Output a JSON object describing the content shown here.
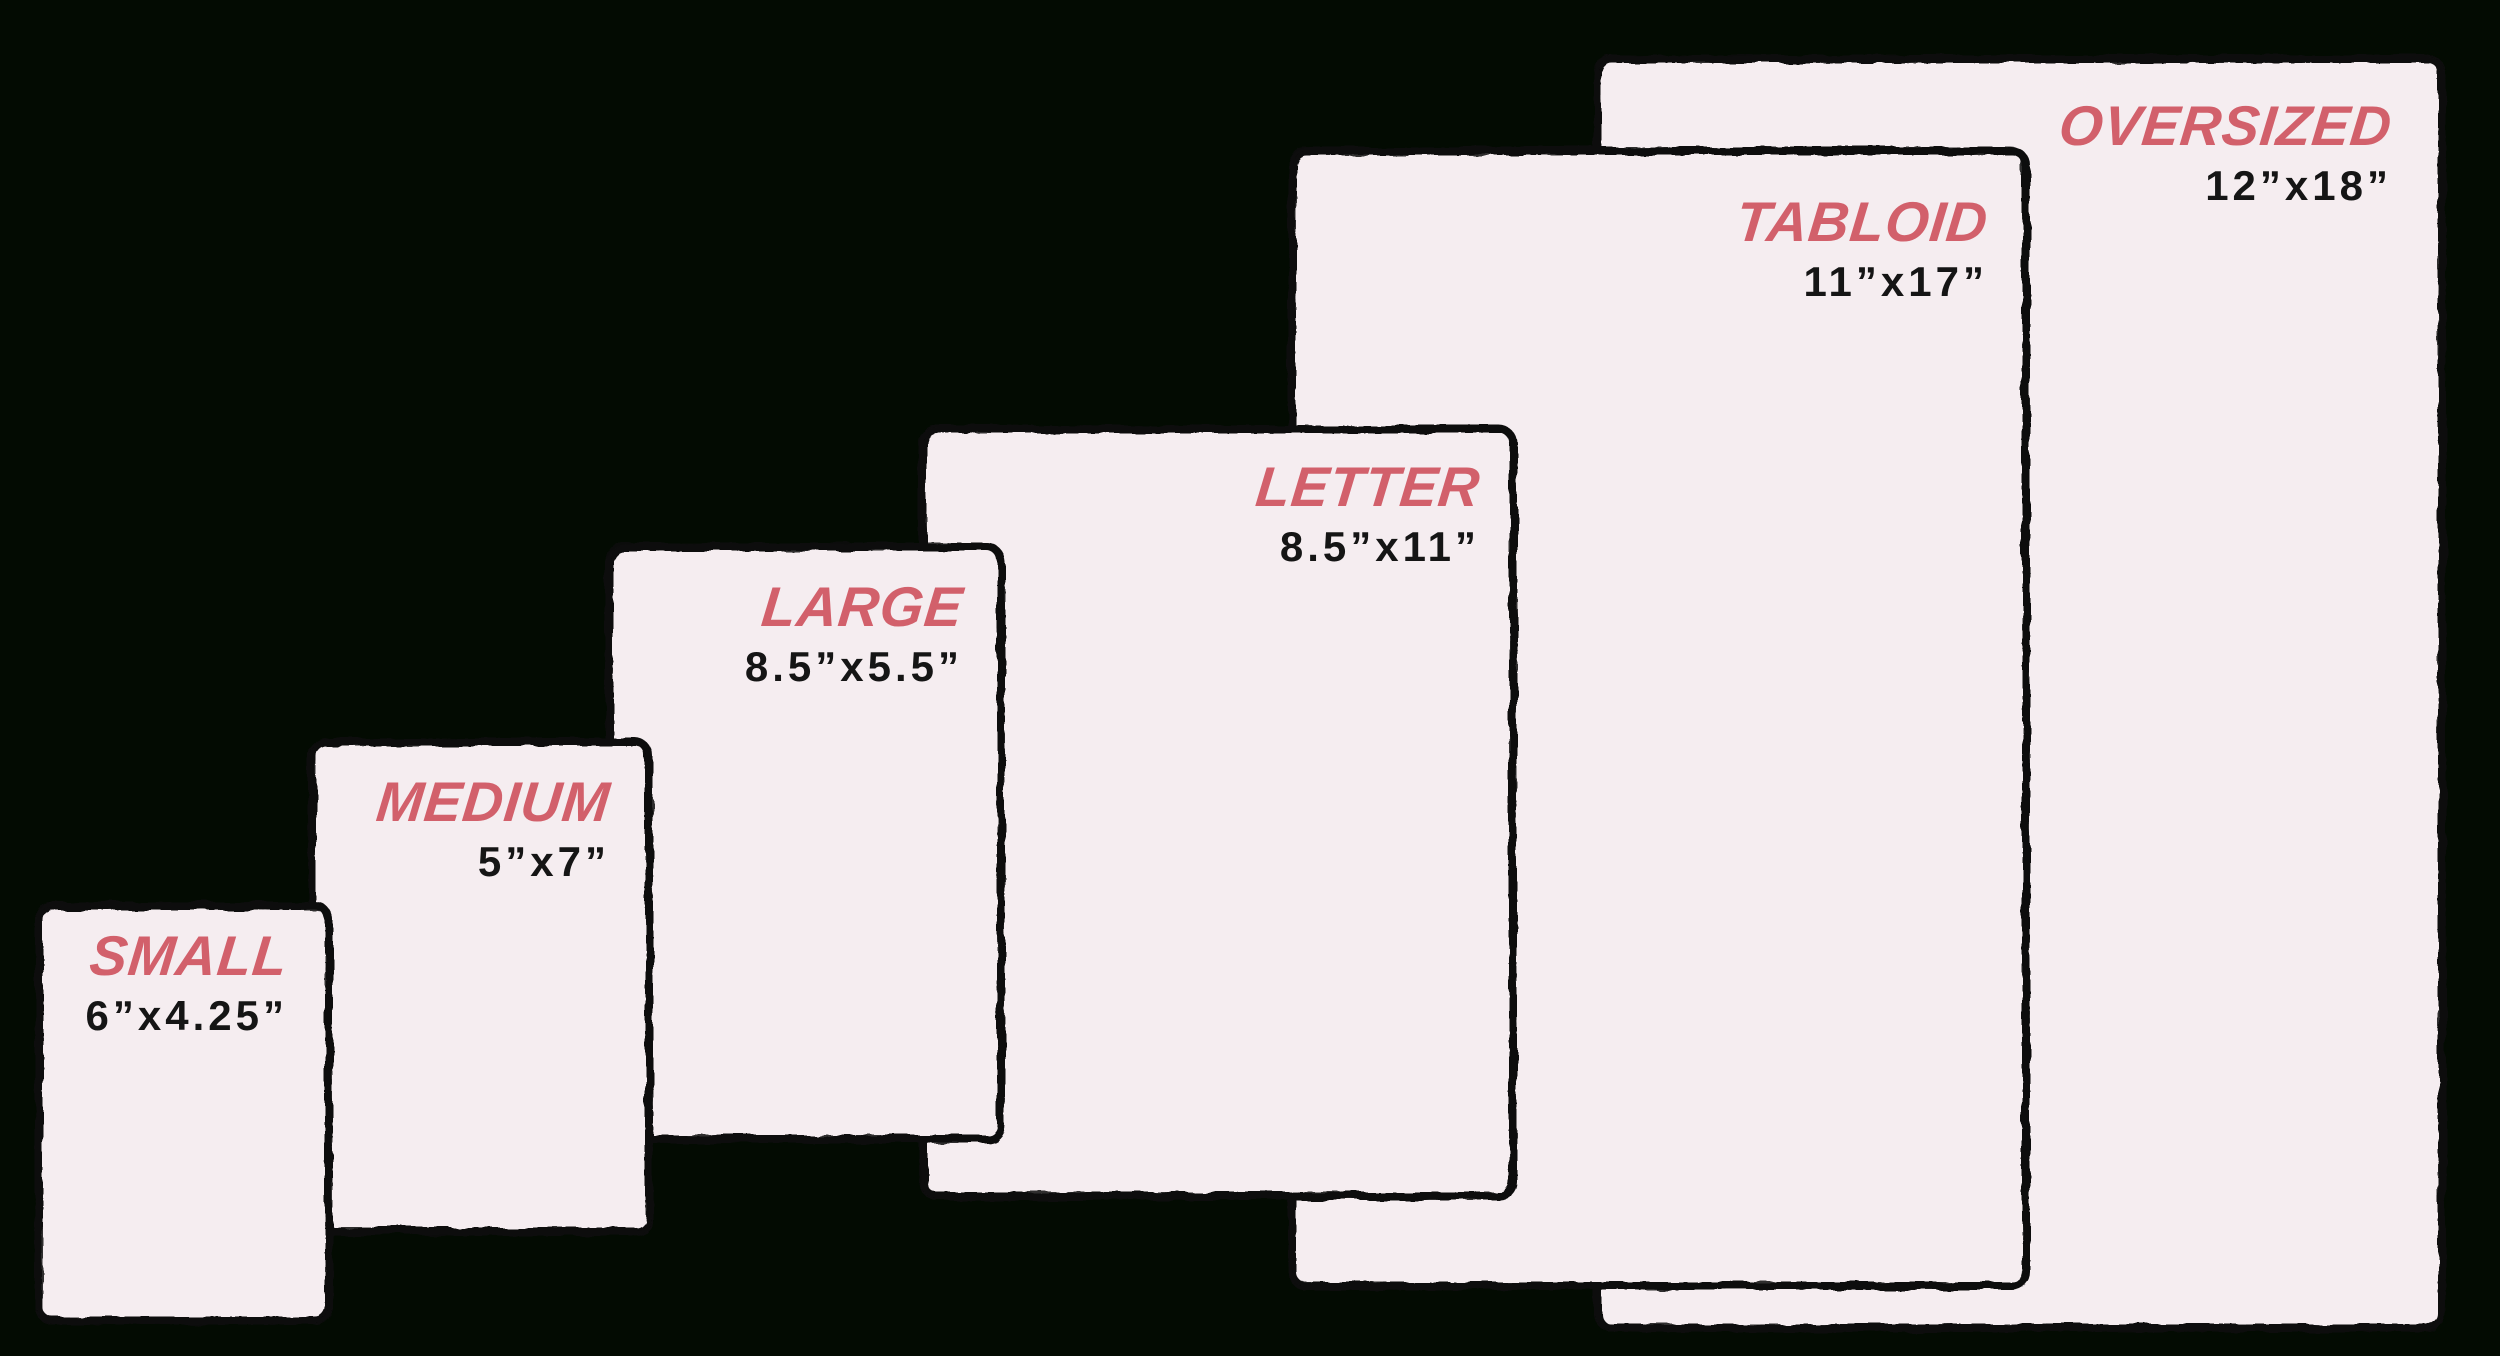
{
  "diagram": {
    "description": "Paper size comparison",
    "colors": {
      "background": "#030b02",
      "card_fill": "#f5edf0",
      "card_border": "#0d0d0d",
      "label_red": "#d2606b",
      "dimension_text": "#151515"
    },
    "cards": [
      {
        "id": "small",
        "label": "SMALL",
        "dimensions": "6”x4.25”"
      },
      {
        "id": "medium",
        "label": "MEDIUM",
        "dimensions": "5”x7”"
      },
      {
        "id": "large",
        "label": "LARGE",
        "dimensions": "8.5”x5.5”"
      },
      {
        "id": "letter",
        "label": "LETTER",
        "dimensions": "8.5”x11”"
      },
      {
        "id": "tabloid",
        "label": "TABLOID",
        "dimensions": "11”x17”"
      },
      {
        "id": "oversized",
        "label": "OVERSIZED",
        "dimensions": "12”x18”"
      }
    ]
  }
}
